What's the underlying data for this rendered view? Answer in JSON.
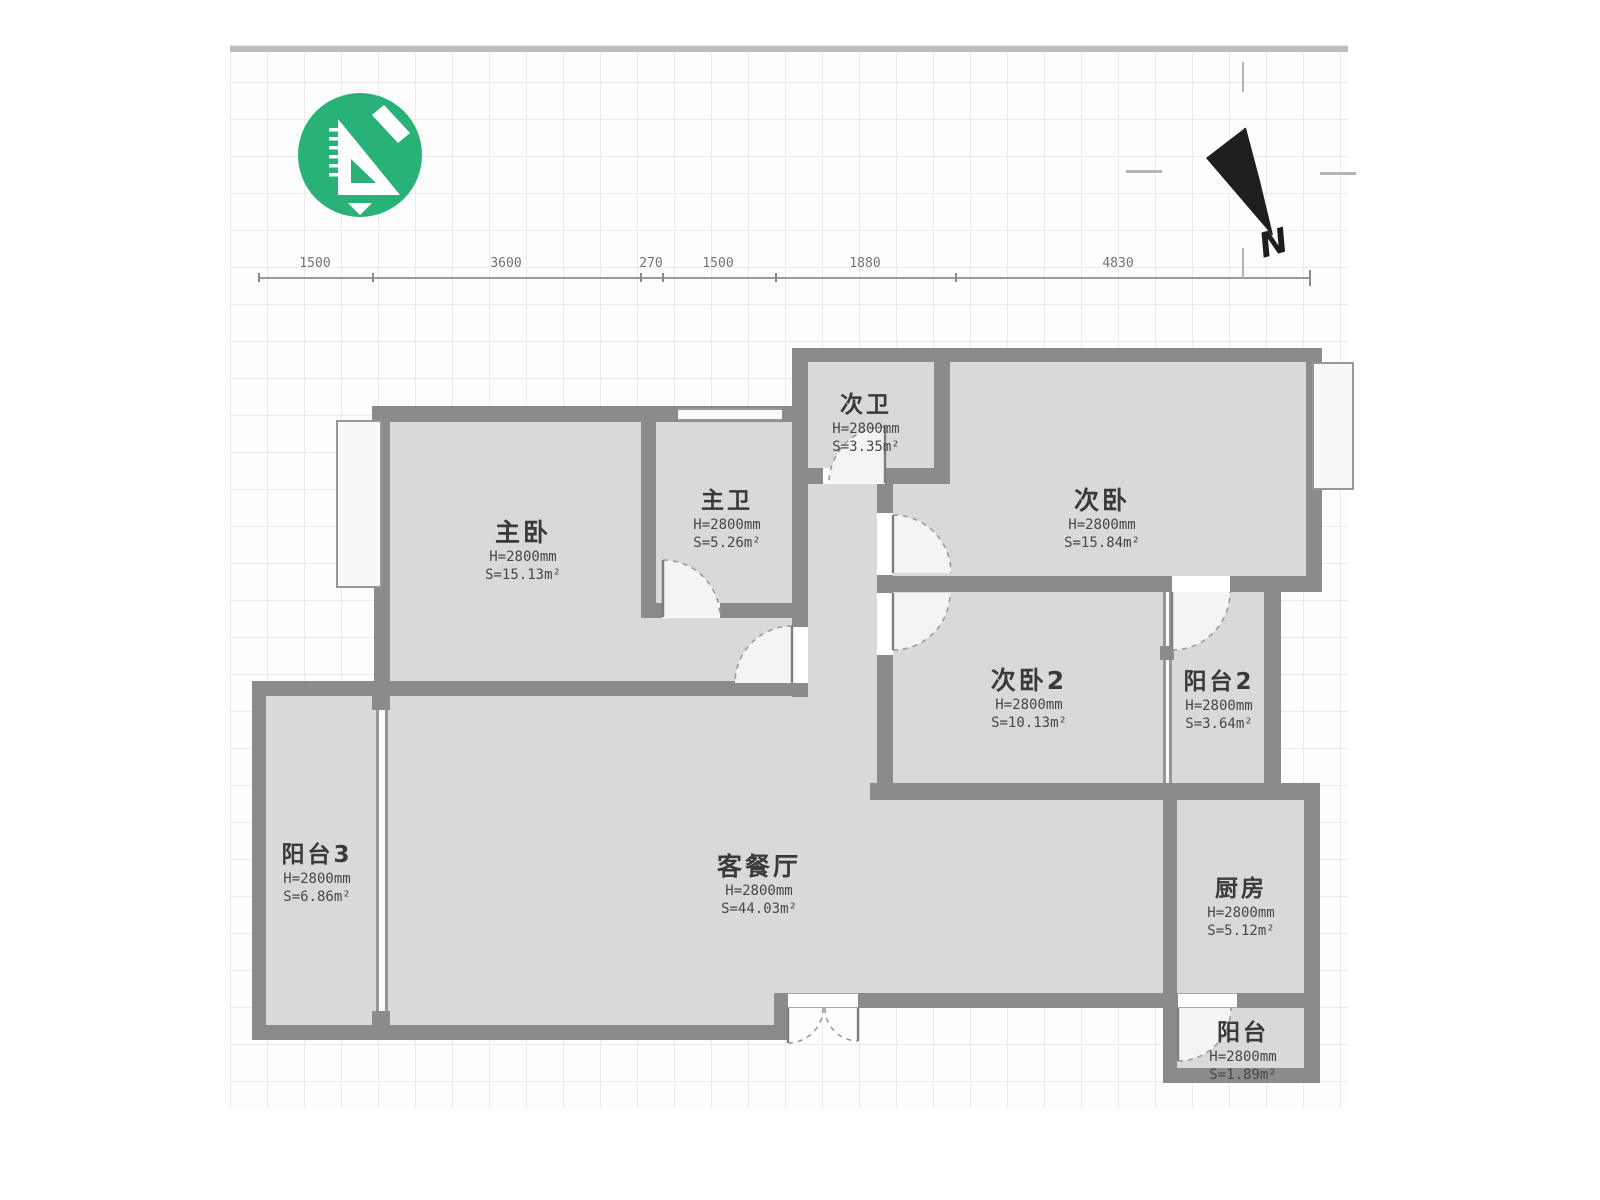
{
  "app": {
    "logo_icon": "set-square-ruler-logo",
    "accent_color": "#29b277",
    "wall_color": "#8b8b8b",
    "room_fill": "#d9d9d9"
  },
  "compass": {
    "label": "N"
  },
  "dimensions": {
    "values": [
      "1500",
      "3600",
      "270",
      "1500",
      "1880",
      "4830"
    ]
  },
  "rooms": [
    {
      "name": "主卧",
      "h": "H=2800mm",
      "s": "S=15.13m²"
    },
    {
      "name": "主卫",
      "h": "H=2800mm",
      "s": "S=5.26m²"
    },
    {
      "name": "次卫",
      "h": "H=2800mm",
      "s": "S=3.35m²"
    },
    {
      "name": "次卧",
      "h": "H=2800mm",
      "s": "S=15.84m²"
    },
    {
      "name": "次卧2",
      "h": "H=2800mm",
      "s": "S=10.13m²"
    },
    {
      "name": "阳台2",
      "h": "H=2800mm",
      "s": "S=3.64m²"
    },
    {
      "name": "阳台3",
      "h": "H=2800mm",
      "s": "S=6.86m²"
    },
    {
      "name": "客餐厅",
      "h": "H=2800mm",
      "s": "S=44.03m²"
    },
    {
      "name": "厨房",
      "h": "H=2800mm",
      "s": "S=5.12m²"
    },
    {
      "name": "阳台",
      "h": "H=2800mm",
      "s": "S=1.89m²"
    }
  ]
}
